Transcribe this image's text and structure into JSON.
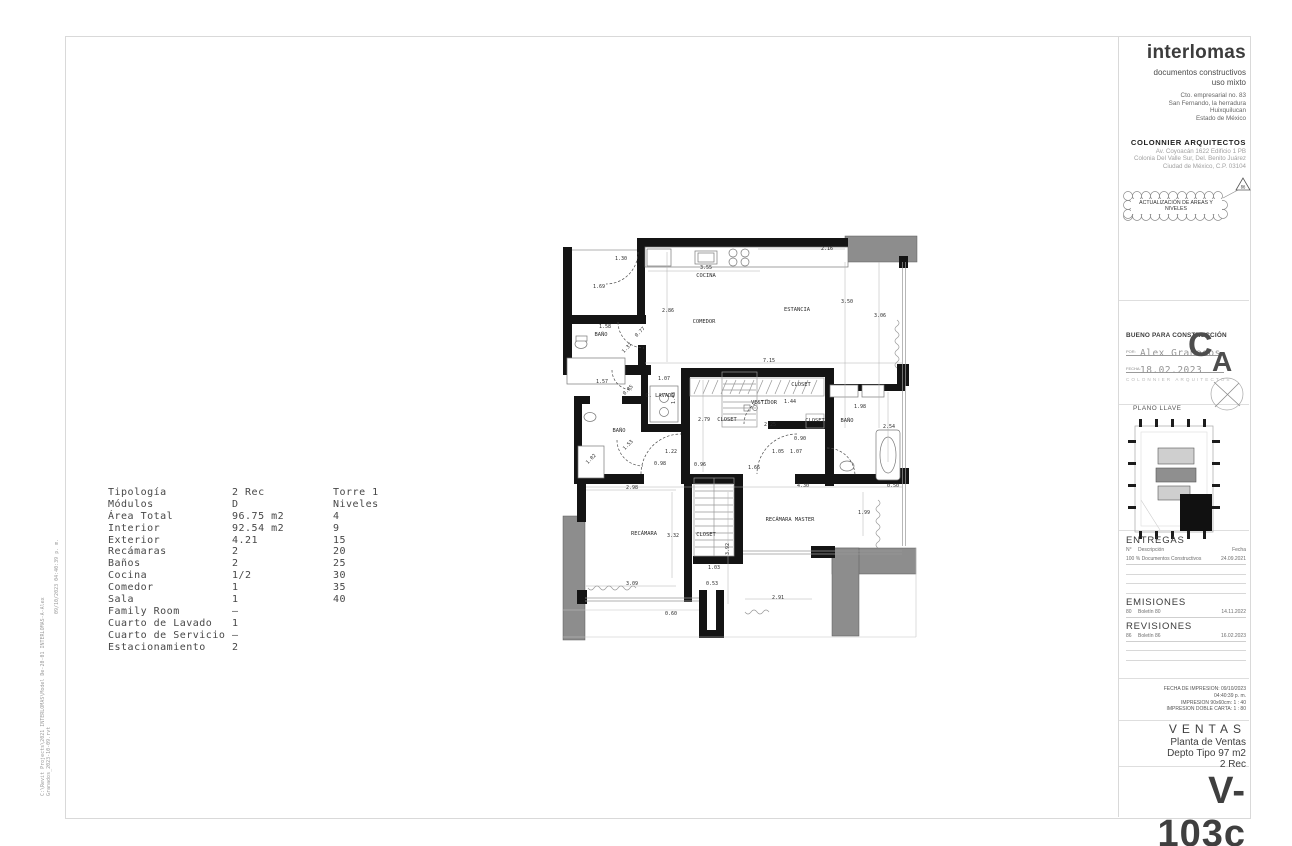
{
  "titleblock": {
    "brand": "interlomas",
    "subtitle": [
      "documentos constructivos",
      "uso mixto"
    ],
    "address": [
      "Cto. empresarial no. 83",
      "San Fernando, la herradura",
      "Huixquilucan",
      "Estado de México"
    ],
    "firm": "COLONNIER ARQUITECTOS",
    "firm_address": [
      "Av. Coyoacán 1622 Edificio 1 PB",
      "Colonia Del Valle Sur, Del. Benito Juárez",
      "Ciudad de México, C.P. 03104"
    ],
    "cloud_note": "ACTUALIZACIÓN DE AREAS Y NIVELES",
    "revision_delta": "86",
    "approval": {
      "title": "BUENO PARA CONSTRUCCIÓN",
      "por_label": "POR:",
      "por_value": "Alex Granados",
      "fecha_label": "FECHA:",
      "fecha_value": "18.02.2023",
      "stamp": "COLONNIER ARQUITECTOS"
    },
    "logo": {
      "c": "C",
      "a": "A"
    },
    "plano_llave": "PLANO LLAVE",
    "entregas": {
      "title": "ENTREGAS",
      "col_n": "N°",
      "col_desc": "Descripción",
      "col_fecha": "Fecha",
      "row": {
        "n": "",
        "desc": "100 % Documentos Constructivos",
        "fecha": "24.09.2021"
      }
    },
    "emisiones": {
      "title": "EMISIONES",
      "row": {
        "n": "80",
        "desc": "Boletín 80",
        "fecha": "14.11.2022"
      }
    },
    "revisiones": {
      "title": "REVISIONES",
      "row": {
        "n": "86",
        "desc": "Boletín 86",
        "fecha": "16.02.2023"
      }
    },
    "print_lines": [
      "FECHA DE IMPRESION:  09/10/2023",
      "04:40:39 p. m.",
      "IMPRESION 90x60cm:   1 : 40",
      "IMPRESION DOBLE CARTA:   1 : 80"
    ],
    "series": "VENTAS",
    "sheet_title": [
      "Planta de Ventas",
      "Depto Tipo 97 m2",
      "2 Rec"
    ],
    "sheet_number": "V-103c"
  },
  "edge_stamps": {
    "timestamp": "09/10/2023 04:40:39 p. m.",
    "filepath_line1": "C:\\Revit Projects\\2021 INTERLOMAS\\Model De-20-01 INTERLOMAS-A-Alex",
    "filepath_line2": "Granados_2023-10-09.rvt"
  },
  "spec_table": {
    "rows": [
      {
        "label": "Tipología",
        "value": "2 Rec"
      },
      {
        "label": "Módulos",
        "value": "D"
      },
      {
        "label": "Área Total",
        "value": "96.75 m2"
      },
      {
        "label": "Interior",
        "value": "92.54 m2"
      },
      {
        "label": "Exterior",
        "value": "4.21"
      },
      {
        "label": "Recámaras",
        "value": "2"
      },
      {
        "label": "Baños",
        "value": "2"
      },
      {
        "label": "Cocina",
        "value": "1/2"
      },
      {
        "label": "Comedor",
        "value": "1"
      },
      {
        "label": "Sala",
        "value": "1"
      },
      {
        "label": "Family Room",
        "value": "–"
      },
      {
        "label": "Cuarto de Lavado",
        "value": "1"
      },
      {
        "label": "Cuarto de Servicio",
        "value": "–"
      },
      {
        "label": "Estacionamiento",
        "value": "2"
      }
    ],
    "tower": [
      "Torre 1",
      "Niveles",
      "4",
      "9",
      "15",
      "20",
      "25",
      "30",
      "35",
      "40"
    ]
  },
  "plan": {
    "rooms": [
      {
        "t": "COCINA",
        "x": 706,
        "y": 277
      },
      {
        "t": "COMEDOR",
        "x": 704,
        "y": 323
      },
      {
        "t": "ESTANCIA",
        "x": 797,
        "y": 311
      },
      {
        "t": "BAÑO",
        "x": 601,
        "y": 336
      },
      {
        "t": "C. LAVADO",
        "x": 660,
        "y": 397
      },
      {
        "t": "BAÑO",
        "x": 619,
        "y": 432
      },
      {
        "t": "VESTIDOR",
        "x": 764,
        "y": 404
      },
      {
        "t": "CLOSET",
        "x": 801,
        "y": 386
      },
      {
        "t": "CLOSET",
        "x": 727,
        "y": 421
      },
      {
        "t": "CLOSET",
        "x": 815,
        "y": 422
      },
      {
        "t": "CLOSET",
        "x": 706,
        "y": 536
      },
      {
        "t": "BAÑO",
        "x": 847,
        "y": 422
      },
      {
        "t": "RECÁMARA",
        "x": 644,
        "y": 535
      },
      {
        "t": "RECÁMARA MASTER",
        "x": 790,
        "y": 521
      }
    ],
    "dims": [
      {
        "t": "1.30",
        "x": 621,
        "y": 260
      },
      {
        "t": "1.69",
        "x": 599,
        "y": 288
      },
      {
        "t": "3.55",
        "x": 706,
        "y": 269
      },
      {
        "t": "2.16",
        "x": 827,
        "y": 250
      },
      {
        "t": "3.50",
        "x": 847,
        "y": 303
      },
      {
        "t": "3.06",
        "x": 880,
        "y": 317
      },
      {
        "t": "2.86",
        "x": 668,
        "y": 312
      },
      {
        "t": "1.58",
        "x": 605,
        "y": 328
      },
      {
        "t": "0.77",
        "x": 641,
        "y": 333,
        "r": 45
      },
      {
        "t": "1.37",
        "x": 628,
        "y": 349,
        "r": 45
      },
      {
        "t": "7.15",
        "x": 769,
        "y": 362
      },
      {
        "t": "1.57",
        "x": 602,
        "y": 383
      },
      {
        "t": "0.85",
        "x": 629,
        "y": 391,
        "r": 45
      },
      {
        "t": "1.07",
        "x": 664,
        "y": 380
      },
      {
        "t": "1.43",
        "x": 675,
        "y": 398,
        "r": 90
      },
      {
        "t": "2.79",
        "x": 704,
        "y": 421
      },
      {
        "t": "1.44",
        "x": 790,
        "y": 403
      },
      {
        "t": "2.25",
        "x": 770,
        "y": 426
      },
      {
        "t": "1.98",
        "x": 860,
        "y": 408
      },
      {
        "t": "2.54",
        "x": 889,
        "y": 428
      },
      {
        "t": "0.90",
        "x": 800,
        "y": 440
      },
      {
        "t": "1.05",
        "x": 778,
        "y": 453
      },
      {
        "t": "1.07",
        "x": 796,
        "y": 453
      },
      {
        "t": "1.22",
        "x": 671,
        "y": 453
      },
      {
        "t": "1.53",
        "x": 629,
        "y": 446,
        "r": 45
      },
      {
        "t": "1.02",
        "x": 592,
        "y": 460,
        "r": 45
      },
      {
        "t": "0.98",
        "x": 660,
        "y": 465
      },
      {
        "t": "0.96",
        "x": 700,
        "y": 466
      },
      {
        "t": "1.66",
        "x": 754,
        "y": 469
      },
      {
        "t": "4.30",
        "x": 803,
        "y": 487
      },
      {
        "t": "0.50",
        "x": 893,
        "y": 487
      },
      {
        "t": "2.98",
        "x": 632,
        "y": 489
      },
      {
        "t": "1.99",
        "x": 864,
        "y": 514
      },
      {
        "t": "3.32",
        "x": 673,
        "y": 537
      },
      {
        "t": "3.92",
        "x": 729,
        "y": 549,
        "r": 90
      },
      {
        "t": "1.03",
        "x": 714,
        "y": 569
      },
      {
        "t": "0.53",
        "x": 712,
        "y": 585
      },
      {
        "t": "3.09",
        "x": 632,
        "y": 585
      },
      {
        "t": "2.91",
        "x": 778,
        "y": 599
      },
      {
        "t": "0.60",
        "x": 671,
        "y": 615
      }
    ]
  }
}
